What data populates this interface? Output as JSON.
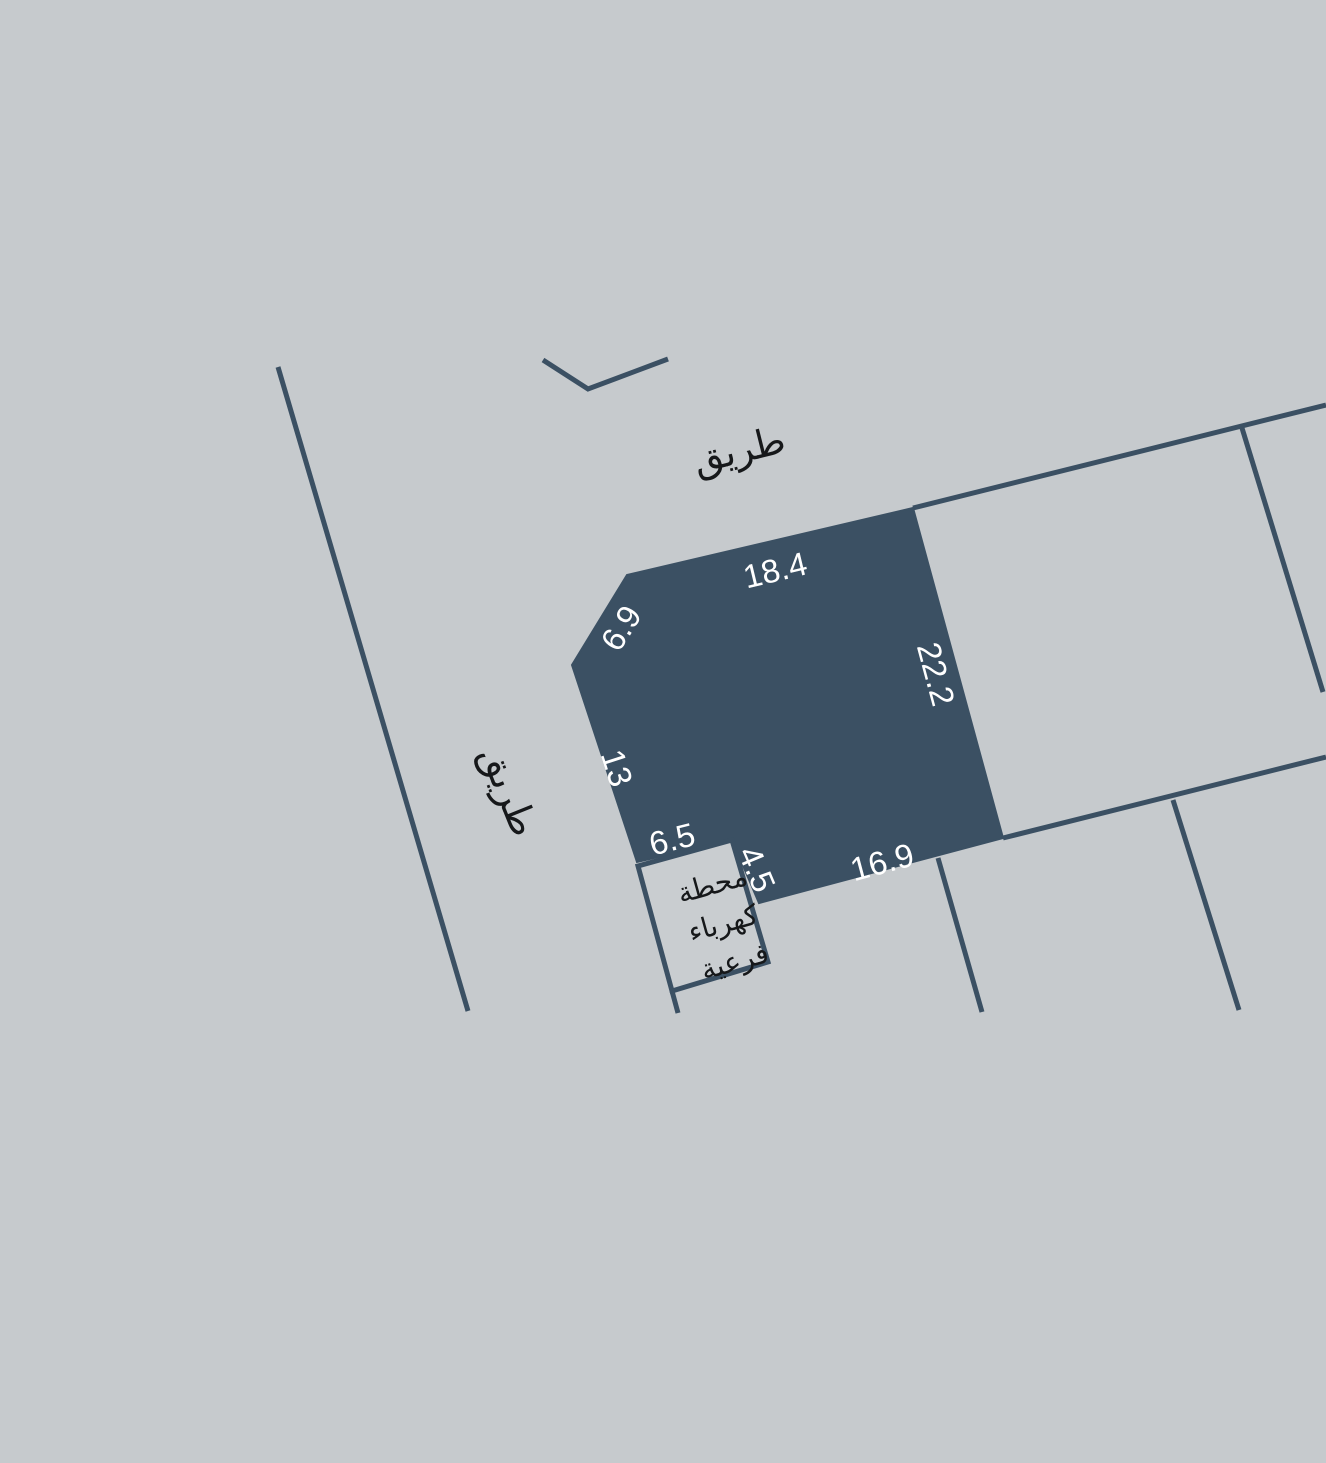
{
  "map": {
    "type": "cadastral-parcel-plan",
    "background_color": "#c6cacd",
    "line_color": "#3b5063",
    "parcel": {
      "fill_color": "#3b5063",
      "label_color": "#ffffff",
      "dimensions": {
        "top_edge": "18.4",
        "chamfer_edge": "6.9",
        "right_edge": "22.2",
        "left_edge": "13",
        "notch_top_edge": "6.5",
        "notch_side_edge": "4.5",
        "bottom_edge": "16.9"
      }
    },
    "roads": {
      "label_color": "#16181a",
      "top_road_label": "طريق",
      "left_road_label": "طريق"
    },
    "substation": {
      "fill_color": "#c9cdd0",
      "stroke_color": "#3b5063",
      "text_color": "#16181a",
      "line1": "محطة",
      "line2": "كهرباء",
      "line3": "فرعية"
    }
  }
}
